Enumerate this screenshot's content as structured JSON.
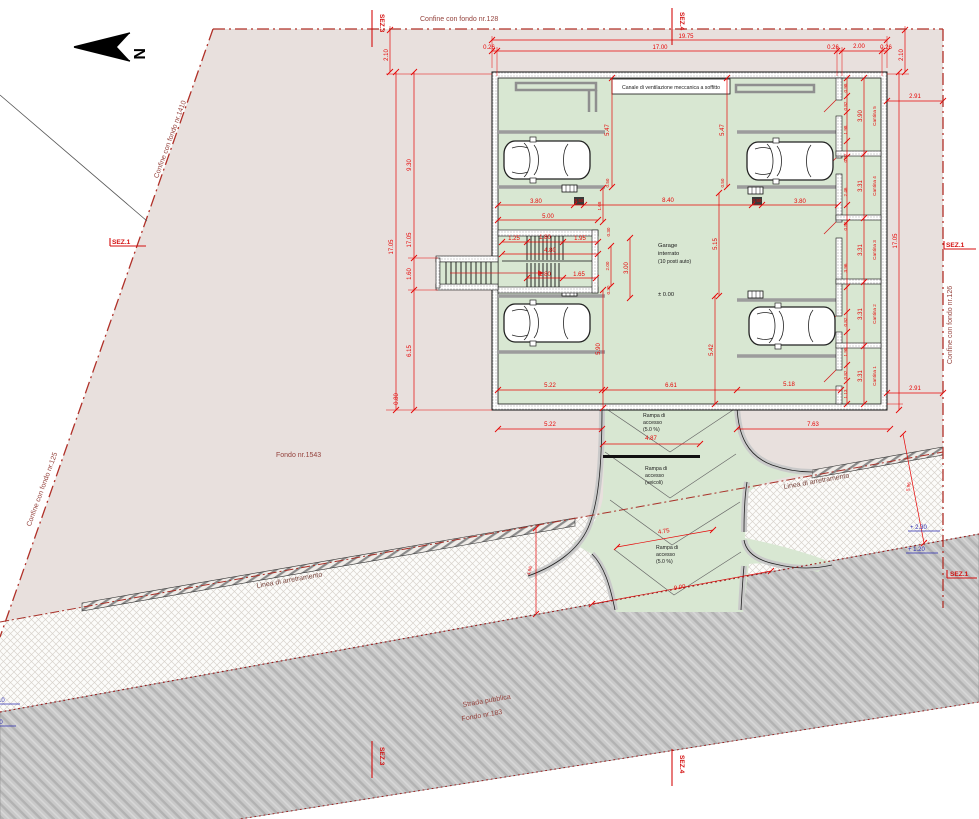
{
  "north": {
    "letter": "N"
  },
  "boundaries": {
    "top": "Confine con fondo nr.128",
    "left_upper": "Confine con fondo nr.1410",
    "left_lower": "Confine con fondo nr.125",
    "right": "Confine con fondo nr.126",
    "setback": "Linea di arretramento"
  },
  "site": {
    "name": "Fondo nr.1543"
  },
  "road": {
    "line1": "Strada pubblica",
    "line2": "Fondo nr.183"
  },
  "sections": {
    "s1": "SEZ.1",
    "s3": "SEZ.3",
    "s4": "SEZ.4"
  },
  "garage": {
    "vent": "Canale di ventilazione meccanica a soffitto",
    "l1": "Garage",
    "l2": "interrato",
    "l3": "(10 posti auto)",
    "level": "± 0.00"
  },
  "ramp": {
    "top": [
      "Rampa di",
      "accesso",
      "(5.0 %)"
    ],
    "mid": [
      "Rampa di",
      "accesso",
      "(veicoli)"
    ],
    "bottom": [
      "Rampa di",
      "accesso",
      "(5.0 %)"
    ]
  },
  "cantine": [
    "Cantina 1",
    "Cantina 2",
    "Cantina 3",
    "Cantina 4",
    "Cantina 5"
  ],
  "dims": {
    "d1975": "19.75",
    "d026": "0.26",
    "d1700": "17.00",
    "d200": "2.00",
    "d210": "2.10",
    "d291": "2.91",
    "d1705": "17.05",
    "d930": "9.30",
    "d160": "1.60",
    "d615": "6.15",
    "d080": "0.80",
    "d547": "5.47",
    "d380": "3.80",
    "d050": "0.50",
    "d840": "8.40",
    "d500": "5.00",
    "d168": "1.68",
    "d125": "1.25",
    "d180": "1.80",
    "d195": "1.95",
    "d480": "4.80",
    "d165": "1.65",
    "d300": "3.00",
    "d030": "0.30",
    "d515": "5.15",
    "d590": "5.90",
    "d542": "5.42",
    "d522": "5.22",
    "d661": "6.61",
    "d518": "5.18",
    "d763": "7.63",
    "d487": "4.87",
    "d475": "4.75",
    "d900": "9.00",
    "d496": "4.96",
    "d596": "5.96",
    "d098": "0.98",
    "d082": "0.82",
    "d198": "1.98",
    "d246": "2.46",
    "d396": "3.96",
    "d113": "1.13",
    "d390": "3.90",
    "d331": "3.31"
  },
  "levels": {
    "plus230": "+ 2.30",
    "plus120": "+ 1.20",
    "left_upper": "1.10",
    "left_lower": "1.00"
  },
  "colors": {
    "site_fill": "#e8e0dd",
    "garage_fill": "#d8e7d2",
    "road_fill": "#c9c9c9",
    "dim_red": "#e60505",
    "boundary_red": "#b03028",
    "level_blue": "#2b2bb0",
    "label_maroon": "#94423c"
  }
}
